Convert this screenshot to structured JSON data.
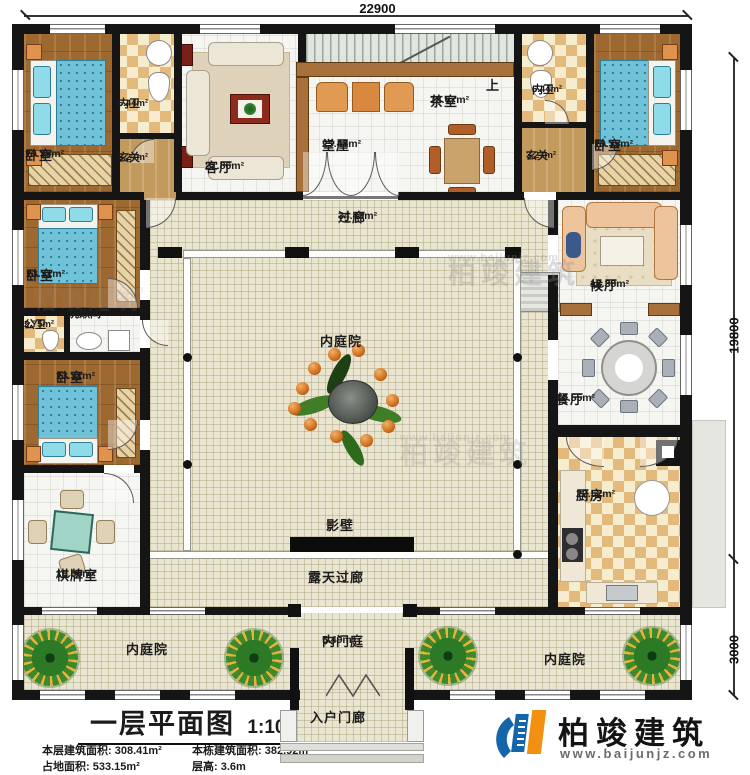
{
  "dimensions": {
    "top": "22900",
    "right": "19800",
    "bottom_right": "3000"
  },
  "stairs": {
    "up_label": "上"
  },
  "rooms": {
    "bedroom_tl": {
      "label": "卧室",
      "area": "19.35m²"
    },
    "bath_tl": {
      "label": "内卫",
      "area": "6.44m²"
    },
    "foyer_tl": {
      "label": "玄关",
      "area": "3.27m²"
    },
    "living": {
      "label": "客厅",
      "area": "21.86m²"
    },
    "hall": {
      "label": "堂屋",
      "area": "25.48m²"
    },
    "tea": {
      "label": "茶室",
      "area": "18.67m²"
    },
    "bath_tr": {
      "label": "内卫",
      "area": "6.44m²"
    },
    "foyer_tr": {
      "label": "玄关",
      "area": "3.27m²"
    },
    "bedroom_tr": {
      "label": "卧室",
      "area": "19.35m²"
    },
    "bedroom_l2": {
      "label": "卧室",
      "area": "13.31m²"
    },
    "public_wc": {
      "label": "公卫",
      "area": "2.75m²"
    },
    "washroom": {
      "label": "洗漱间",
      "area": "3.06m²"
    },
    "bedroom_l3": {
      "label": "卧室",
      "area": "13.31m²"
    },
    "chess": {
      "label": "棋牌室",
      "area": "18.06m²"
    },
    "waiting": {
      "label": "候厅",
      "area": "13.38m²"
    },
    "dining": {
      "label": "餐厅",
      "area": "16.55m²"
    },
    "kitchen": {
      "label": "厨房",
      "area": "22.52m²"
    },
    "corridor": {
      "label": "过廊",
      "area": "34.43m²"
    },
    "inner_courtyard": {
      "label": "内庭院"
    },
    "screen_wall": {
      "label": "影壁"
    },
    "open_corridor": {
      "label": "露天过廊"
    },
    "court_left": {
      "label": "内庭院"
    },
    "court_right": {
      "label": "内庭院"
    },
    "inner_gate": {
      "label": "内门庭",
      "area": "5.49m²"
    },
    "porch": {
      "label": "入户门廊"
    }
  },
  "title_block": {
    "title": "一层平面图",
    "scale": "1:100",
    "stats": [
      {
        "label": "本层建筑面积:",
        "value": "308.41m²"
      },
      {
        "label": "本栋建筑面积:",
        "value": "382.92m²"
      },
      {
        "label": "占地面积:",
        "value": "533.15m²"
      },
      {
        "label": "层高:",
        "value": "3.6m"
      }
    ]
  },
  "logo": {
    "name": "柏竣建筑",
    "website": "www.baijunjz.com"
  },
  "watermark": {
    "name": "柏竣建筑",
    "website": "www.baijunjz.com"
  },
  "colors": {
    "accent_blue": "#1565ab",
    "accent_orange": "#f29111",
    "wall": "#151515",
    "wood": "#9e6831",
    "tile": "#eae5d0"
  }
}
